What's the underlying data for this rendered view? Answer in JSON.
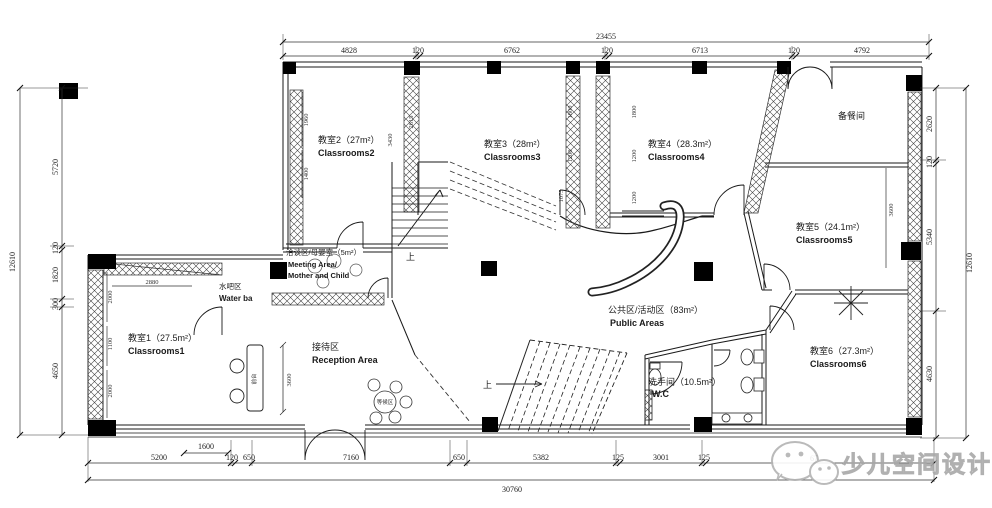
{
  "watermark": {
    "text": "少儿空间设计",
    "icon": "wechat-logo"
  },
  "rooms": {
    "c1": {
      "cn": "教室1（27.5m²）",
      "en": "Classrooms1"
    },
    "c2": {
      "cn": "教室2（27m²）",
      "en": "Classrooms2"
    },
    "c3": {
      "cn": "教室3（28m²）",
      "en": "Classrooms3"
    },
    "c4": {
      "cn": "教室4（28.3m²）",
      "en": "Classrooms4"
    },
    "c5": {
      "cn": "教室5（24.1m²）",
      "en": "Classrooms5"
    },
    "c6": {
      "cn": "教室6（27.3m²）",
      "en": "Classrooms6"
    },
    "pantry": {
      "cn": "备餐间"
    },
    "wc": {
      "cn": "洗手间（10.5m²）",
      "en": "W.C"
    },
    "public": {
      "cn": "公共区/活动区（83m²）",
      "en": "Public Areas"
    },
    "meeting": {
      "cn": "洽谈区/母婴室（5m²）",
      "en1": "Meeting Area/",
      "en2": "Mother and Child"
    },
    "waterbar": {
      "cn": "水吧区",
      "en": "Water ba"
    },
    "reception": {
      "cn": "接待区",
      "en": "Reception Area"
    }
  },
  "labels": {
    "up": "上",
    "desk": "前台",
    "waiting": "等候区"
  },
  "dims": {
    "top": {
      "total": "23455",
      "segs": [
        "4828",
        "120",
        "6762",
        "120",
        "6713",
        "120",
        "4792"
      ]
    },
    "bottom": {
      "total": "30760",
      "segs": [
        "5200",
        "120",
        "650",
        "7160",
        "650",
        "5382",
        "125",
        "3001",
        "125",
        "67"
      ],
      "door": "1600"
    },
    "left": {
      "total": "12610",
      "segs": [
        "5720",
        "120",
        "1820",
        "300",
        "4650"
      ]
    },
    "right": {
      "total": "12610",
      "segs": [
        "2620",
        "120",
        "5340",
        "4630"
      ]
    },
    "interior": [
      "1960",
      "1400",
      "3430",
      "2615",
      "1800",
      "1200",
      "1800",
      "1200",
      "1200",
      "1075",
      "2000",
      "1100",
      "2000",
      "2880",
      "3600",
      "3600"
    ]
  }
}
